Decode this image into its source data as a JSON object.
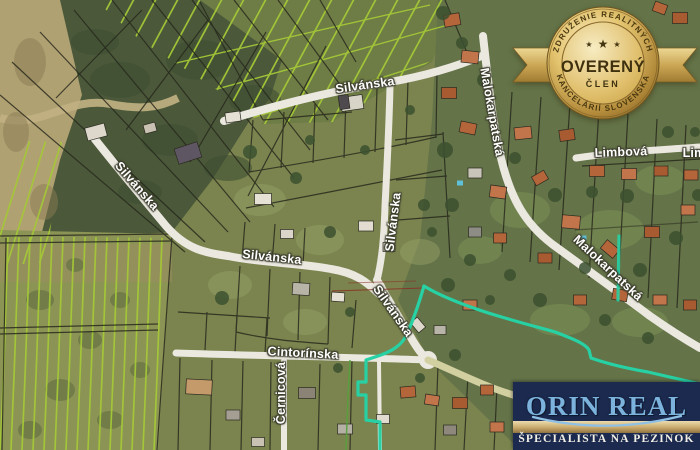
{
  "map": {
    "street_labels": [
      {
        "text": "Silvánska"
      },
      {
        "text": "Silvánska"
      },
      {
        "text": "Silvánska"
      },
      {
        "text": "Silvánska"
      },
      {
        "text": "Silvánska"
      },
      {
        "text": "Malokarpatská"
      },
      {
        "text": "Malokarpatská"
      },
      {
        "text": "Limbová"
      },
      {
        "text": "Lim"
      },
      {
        "text": "Cintorínska"
      },
      {
        "text": "Černicová"
      }
    ],
    "highlight_color": "#27d1a4",
    "vineyard_line_color": "#a4c838"
  },
  "badge": {
    "arc_top": "ZDRUŽENIE REALITNÝCH",
    "title": "OVERENÝ",
    "subtitle": "ČLEN",
    "arc_bottom": "KANCELÁRIÍ SLOVENSKA",
    "stars": [
      "★",
      "★",
      "★"
    ],
    "gold_color": "#c9a851"
  },
  "logo": {
    "name": "ORIN REAL",
    "tagline": "ŠPECIALISTA NA PEZINOK",
    "navy_color": "#1b2a4e",
    "blue_color": "#7cb3dc",
    "gold_color": "#c9a96c"
  }
}
